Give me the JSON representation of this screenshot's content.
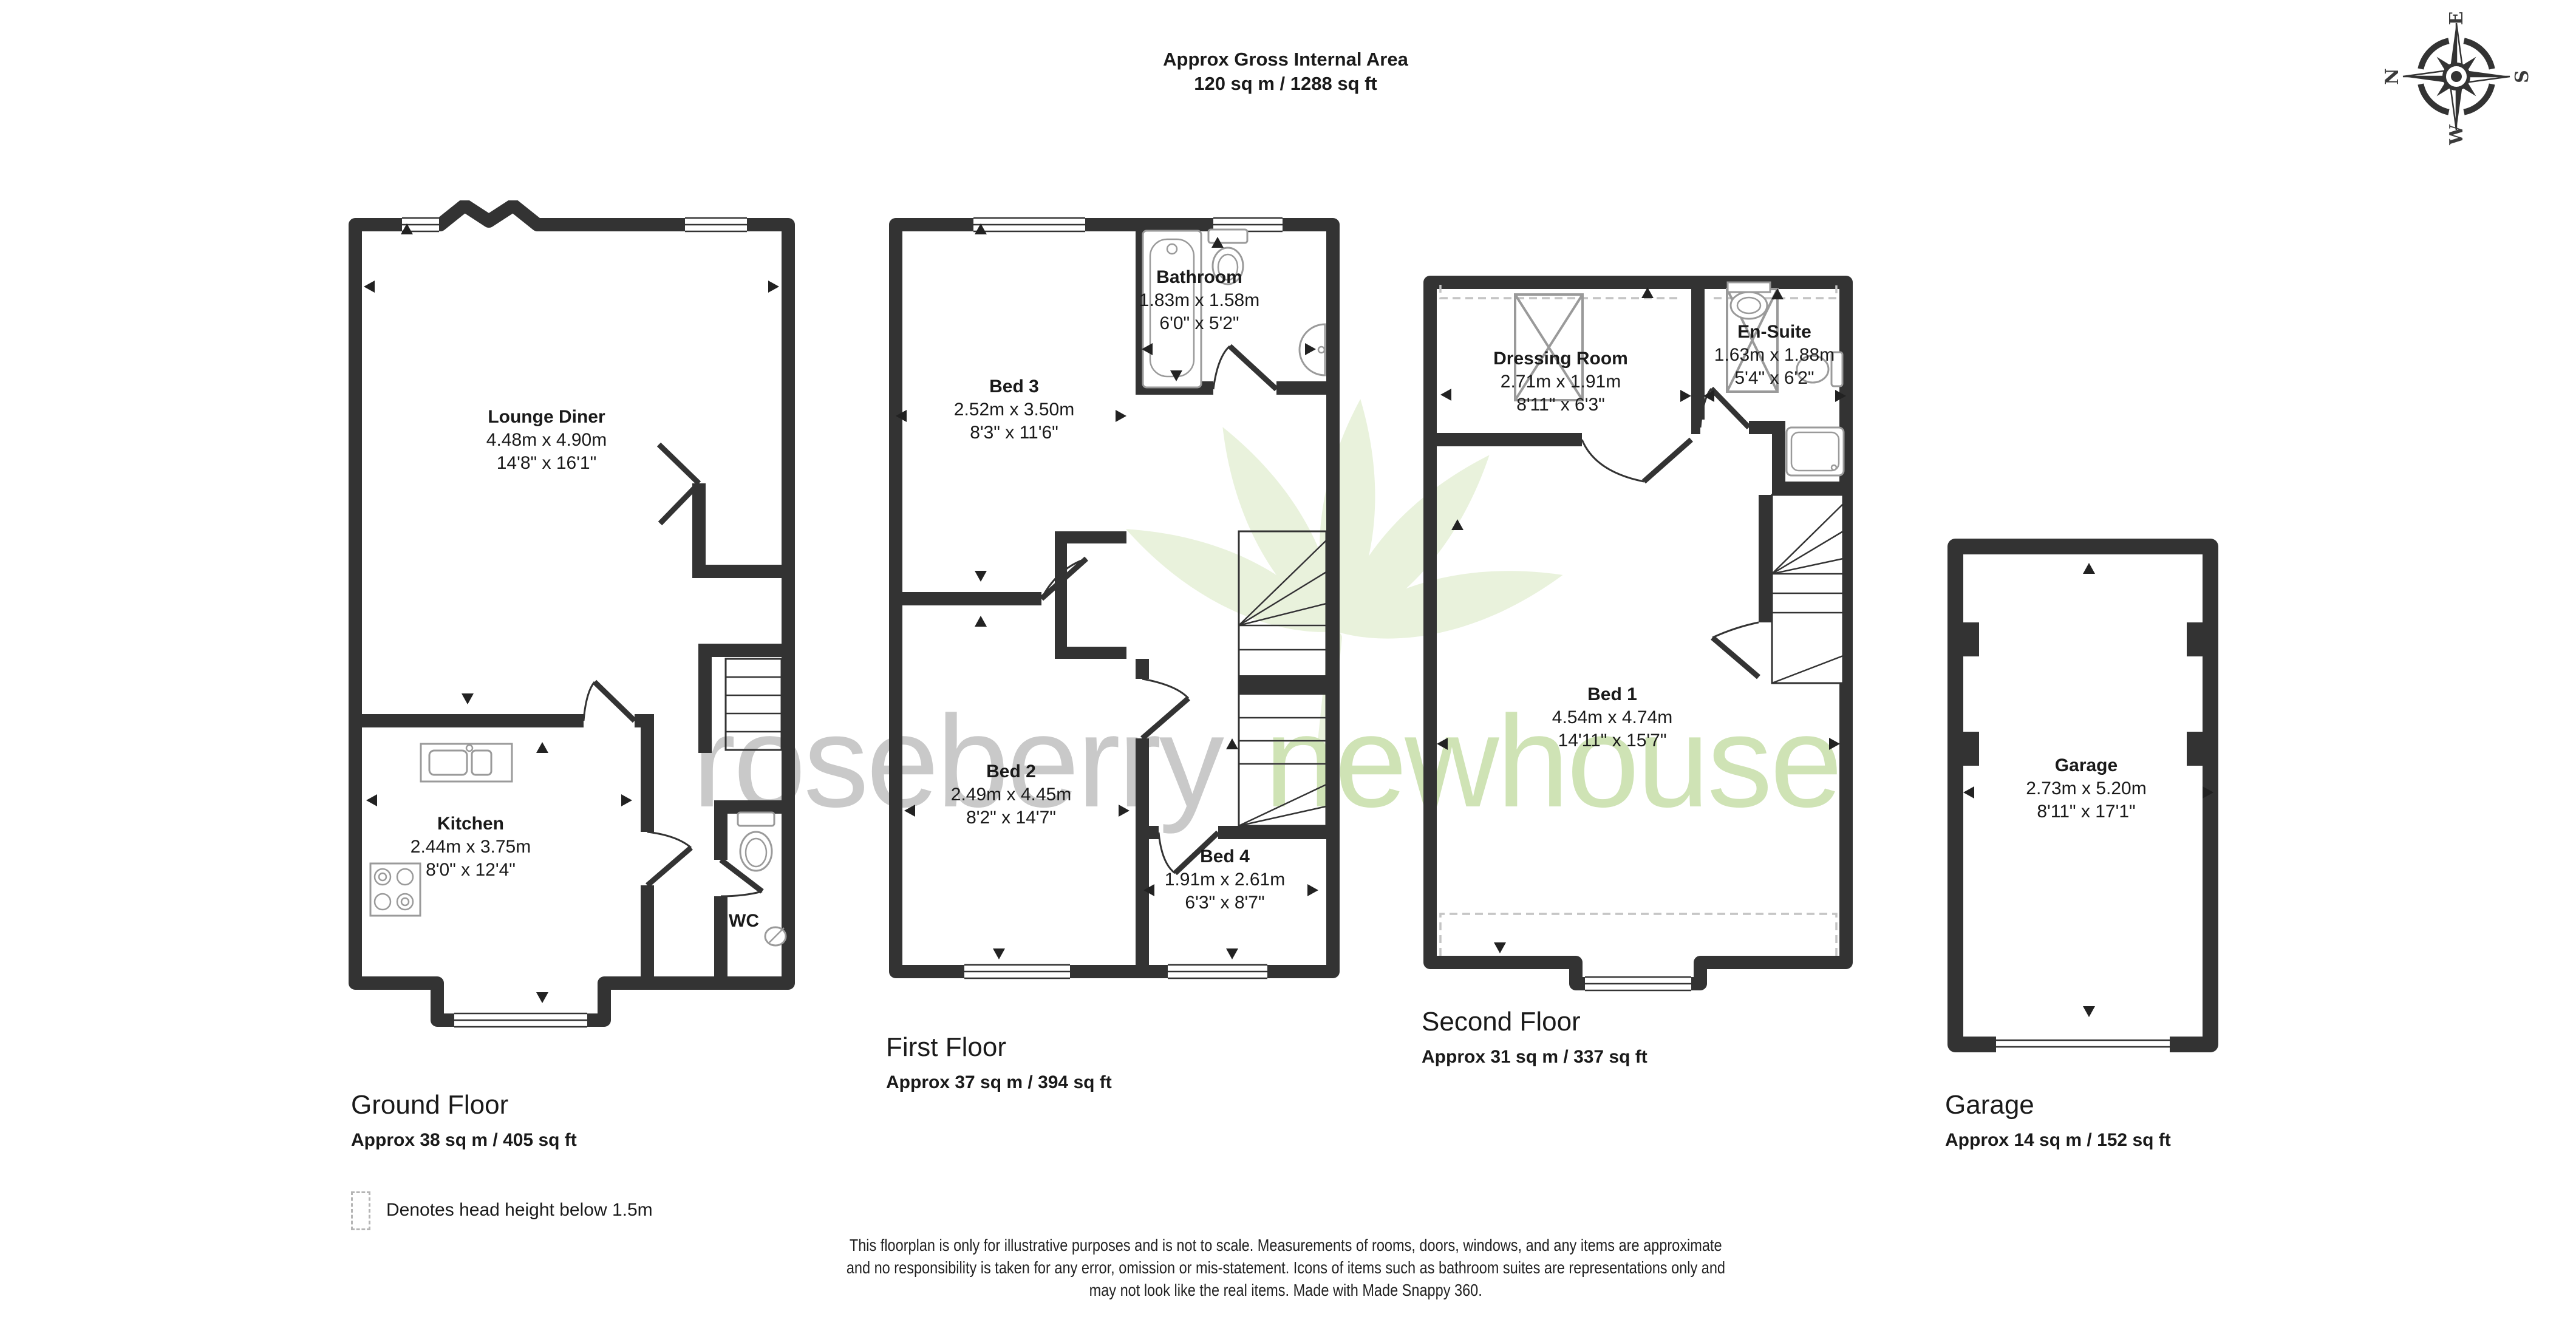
{
  "header": {
    "line1": "Approx Gross Internal Area",
    "line2": "120 sq m / 1288 sq ft"
  },
  "compass": {
    "n": "N",
    "e": "E",
    "s": "S",
    "w": "W"
  },
  "floors": [
    {
      "id": "ground",
      "label": "Ground Floor",
      "area": "Approx 38 sq m / 405 sq ft",
      "rooms": [
        {
          "name": "Lounge Diner",
          "metric": "4.48m x 4.90m",
          "imperial": "14'8\" x 16'1\""
        },
        {
          "name": "Kitchen",
          "metric": "2.44m x 3.75m",
          "imperial": "8'0\" x 12'4\""
        },
        {
          "name": "WC"
        }
      ]
    },
    {
      "id": "first",
      "label": "First Floor",
      "area": "Approx 37 sq m / 394 sq ft",
      "rooms": [
        {
          "name": "Bed 3",
          "metric": "2.52m x 3.50m",
          "imperial": "8'3\" x 11'6\""
        },
        {
          "name": "Bathroom",
          "metric": "1.83m x 1.58m",
          "imperial": "6'0\" x 5'2\""
        },
        {
          "name": "Bed 2",
          "metric": "2.49m x 4.45m",
          "imperial": "8'2\" x 14'7\""
        },
        {
          "name": "Bed 4",
          "metric": "1.91m x 2.61m",
          "imperial": "6'3\" x 8'7\""
        }
      ]
    },
    {
      "id": "second",
      "label": "Second Floor",
      "area": "Approx 31 sq m / 337 sq ft",
      "rooms": [
        {
          "name": "Dressing Room",
          "metric": "2.71m x 1.91m",
          "imperial": "8'11\" x 6'3\""
        },
        {
          "name": "En-Suite",
          "metric": "1.63m x 1.88m",
          "imperial": "5'4\" x 6'2\""
        },
        {
          "name": "Bed 1",
          "metric": "4.54m x 4.74m",
          "imperial": "14'11\" x 15'7\""
        }
      ]
    },
    {
      "id": "garage",
      "label": "Garage",
      "area": "Approx 14 sq m / 152 sq ft",
      "rooms": [
        {
          "name": "Garage",
          "metric": "2.73m x 5.20m",
          "imperial": "8'11\" x 17'1\""
        }
      ]
    }
  ],
  "legend": {
    "text": "Denotes head height below 1.5m"
  },
  "disclaimer": {
    "line1": "This floorplan is only for illustrative purposes and is not to scale. Measurements of rooms, doors, windows, and any items are approximate",
    "line2": "and no responsibility is taken for any error, omission or mis-statement. Icons of items such as bathroom suites are representations only and",
    "line3": "may not look like the real items. Made with Made Snappy 360."
  },
  "watermark": {
    "word1": "roseberry",
    "word2": "newhouse"
  },
  "colors": {
    "wall": "#333333",
    "fixture": "#9a9a9a",
    "watermark_gray": "#c9c9c9",
    "watermark_green": "#cfe3b5",
    "leaf": "#e9f2dc"
  }
}
